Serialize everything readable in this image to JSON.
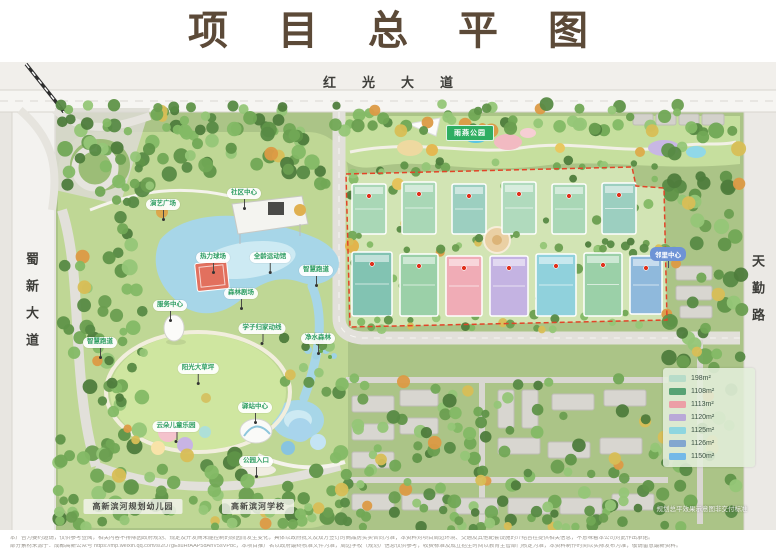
{
  "title": "项目总平图",
  "roads": {
    "top": "红光大道",
    "left": "蜀新大道",
    "right": "天勤路"
  },
  "area_labels": {
    "linear_park": "雨燕公园",
    "neighborhood_center": "邻里中心",
    "kindergarten": "高新滨河规划幼儿园",
    "school": "高新滨河学校",
    "watermark": "规划总平效果示意图非交付标准"
  },
  "park_labels": [
    "演艺广场",
    "社区中心",
    "热力球场",
    "全龄运动馆",
    "智慧跑道",
    "森林剧场",
    "服务中心",
    "学子归家动线",
    "净水森林",
    "阳光大草坪",
    "智慧跑道",
    "驿站中心",
    "云朵儿童乐园",
    "公园入口"
  ],
  "legend": {
    "items": [
      {
        "label": "198m²",
        "color": "#b7dcc9"
      },
      {
        "label": "1108m²",
        "color": "#57a274"
      },
      {
        "label": "1113m²",
        "color": "#ec9fa6"
      },
      {
        "label": "1120m²",
        "color": "#b9a9d8"
      },
      {
        "label": "1125m²",
        "color": "#8ed6e0"
      },
      {
        "label": "1126m²",
        "color": "#82a7cf"
      },
      {
        "label": "1150m²",
        "color": "#74b9e8"
      }
    ]
  },
  "disclaimer": {
    "line1": "本广告为要约邀请，仅供参考查阅，相关内容不排除因政府规划、规定及开发商未能控制的原因而发生变化，具体以政府批文及双方签订的商品房买卖合同为准；本资料对项目周边环境、交通及其他配套设施的介绍旨在提供相关信息，不意味着本公司对此作出承诺。",
    "line2": "部分素材来源于：成都高新公众号 https://mp.weixin.qq.com/s/2rJ7gEsuHrAAP5dAhV5sVPbc，本项目推广名以政府最终核准文件为准，周边学校（规划）信息仅供参考，收费标准及成立招生时间以教育主管部门核定为准，本资料制作时间以实际发布为准，敬请留意最新资料。"
  },
  "colors": {
    "title": "#5c4a38",
    "boundary_red": "#e24428",
    "water": "#a7d6e8",
    "label_green": "#2f9e63",
    "banner_green": "#2fae62",
    "pill_blue": "#6e93d6"
  }
}
